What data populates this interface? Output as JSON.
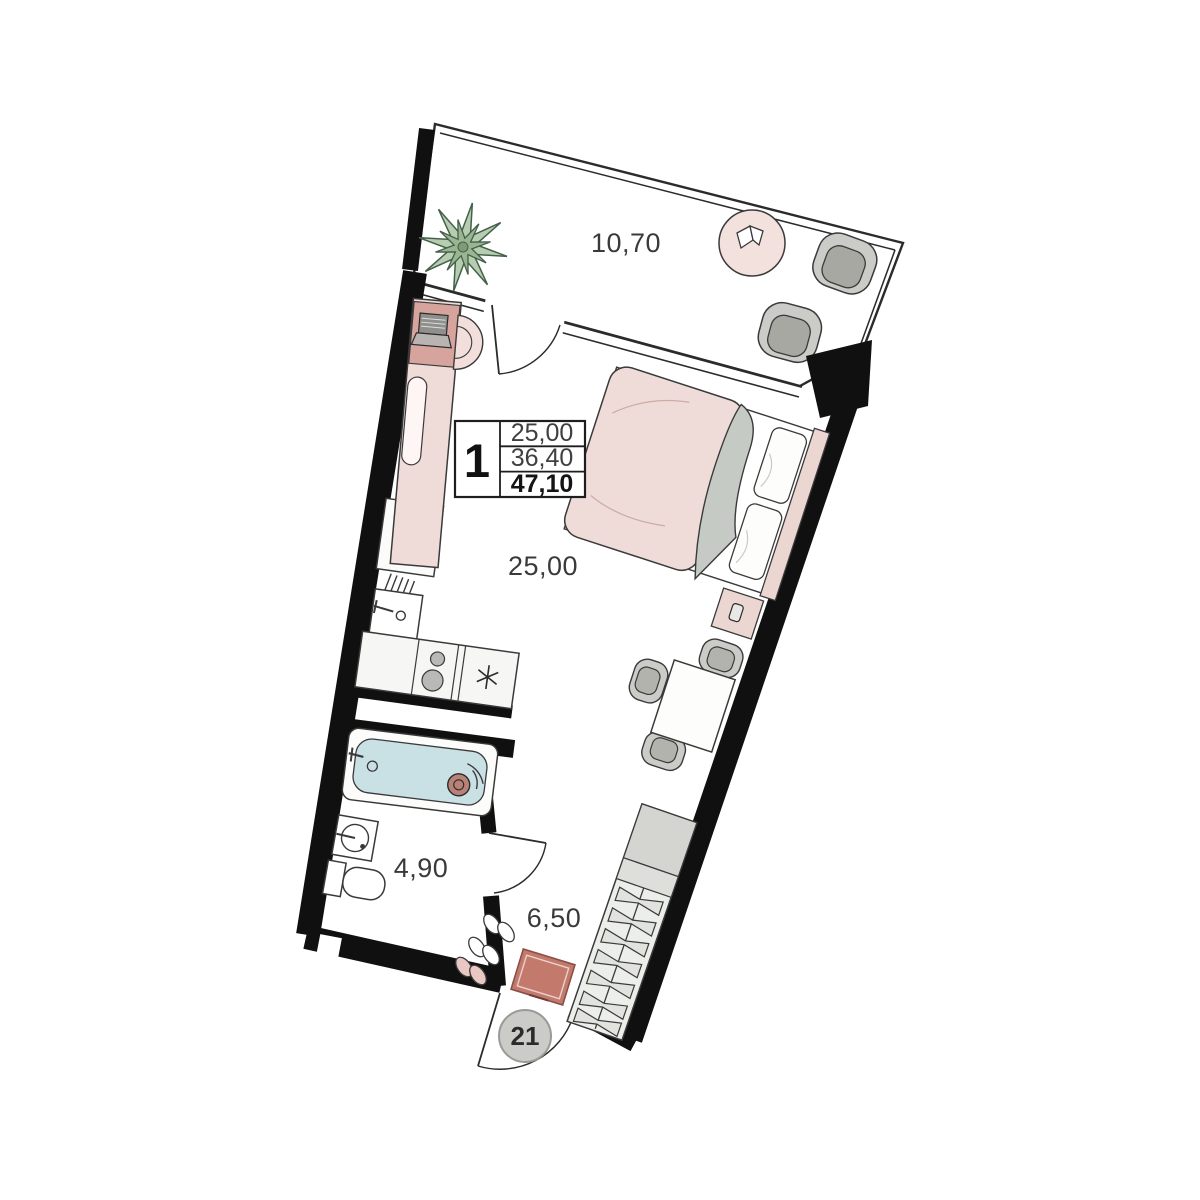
{
  "plan": {
    "labels": {
      "balcony": "10,70",
      "living_room": "25,00",
      "bathroom": "4,90",
      "hallway": "6,50"
    },
    "info_box": {
      "rooms_count": "1",
      "living_area": "25,00",
      "area_without_balcony": "36,40",
      "total_area": "47,10"
    },
    "entrance": {
      "unit_number": "21"
    },
    "icons": {
      "fridge": "snowflake-icon",
      "stove": "two-burner-icon",
      "plant": "star-leaf-plant-icon"
    },
    "colors": {
      "wall": "#101010",
      "outline": "#3a3a3a",
      "pink_light": "#efdcd8",
      "pink_panel": "#d6a49c",
      "terracotta_pouf": "#c4796d",
      "water_blue": "#c9e0e5",
      "furniture_gray": "#cbcbc7",
      "seat_gray": "#a8a8a3",
      "blanket_gray": "#c6cac5",
      "plant_green": "#b7cdb0",
      "plant_green_dark": "#99b691",
      "wardrobe_gray": "#e6e6e3"
    }
  }
}
